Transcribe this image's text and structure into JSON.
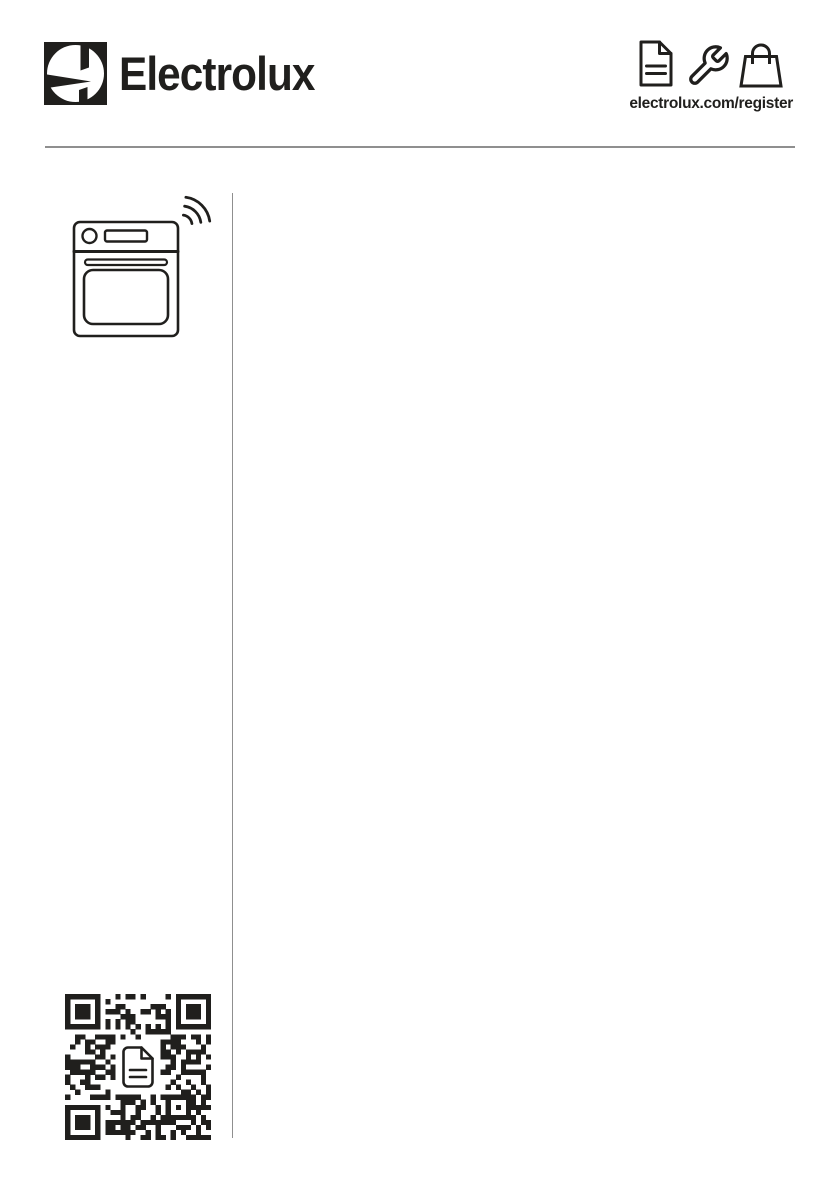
{
  "brand": {
    "wordmark": "Electrolux",
    "symbol_icon": "electrolux-symbol-icon"
  },
  "header": {
    "register_url": "electrolux.com/register",
    "icon_names": [
      "document-icon",
      "wrench-icon",
      "shopping-bag-icon"
    ]
  },
  "left_column": {
    "appliance_icon": "oven-with-wifi-icon",
    "qr_code": {
      "name": "qr-code",
      "center_icon": "document-icon"
    }
  },
  "colors": {
    "ink": "#201f1d",
    "rule": "#8f8f8f",
    "background": "#ffffff"
  }
}
